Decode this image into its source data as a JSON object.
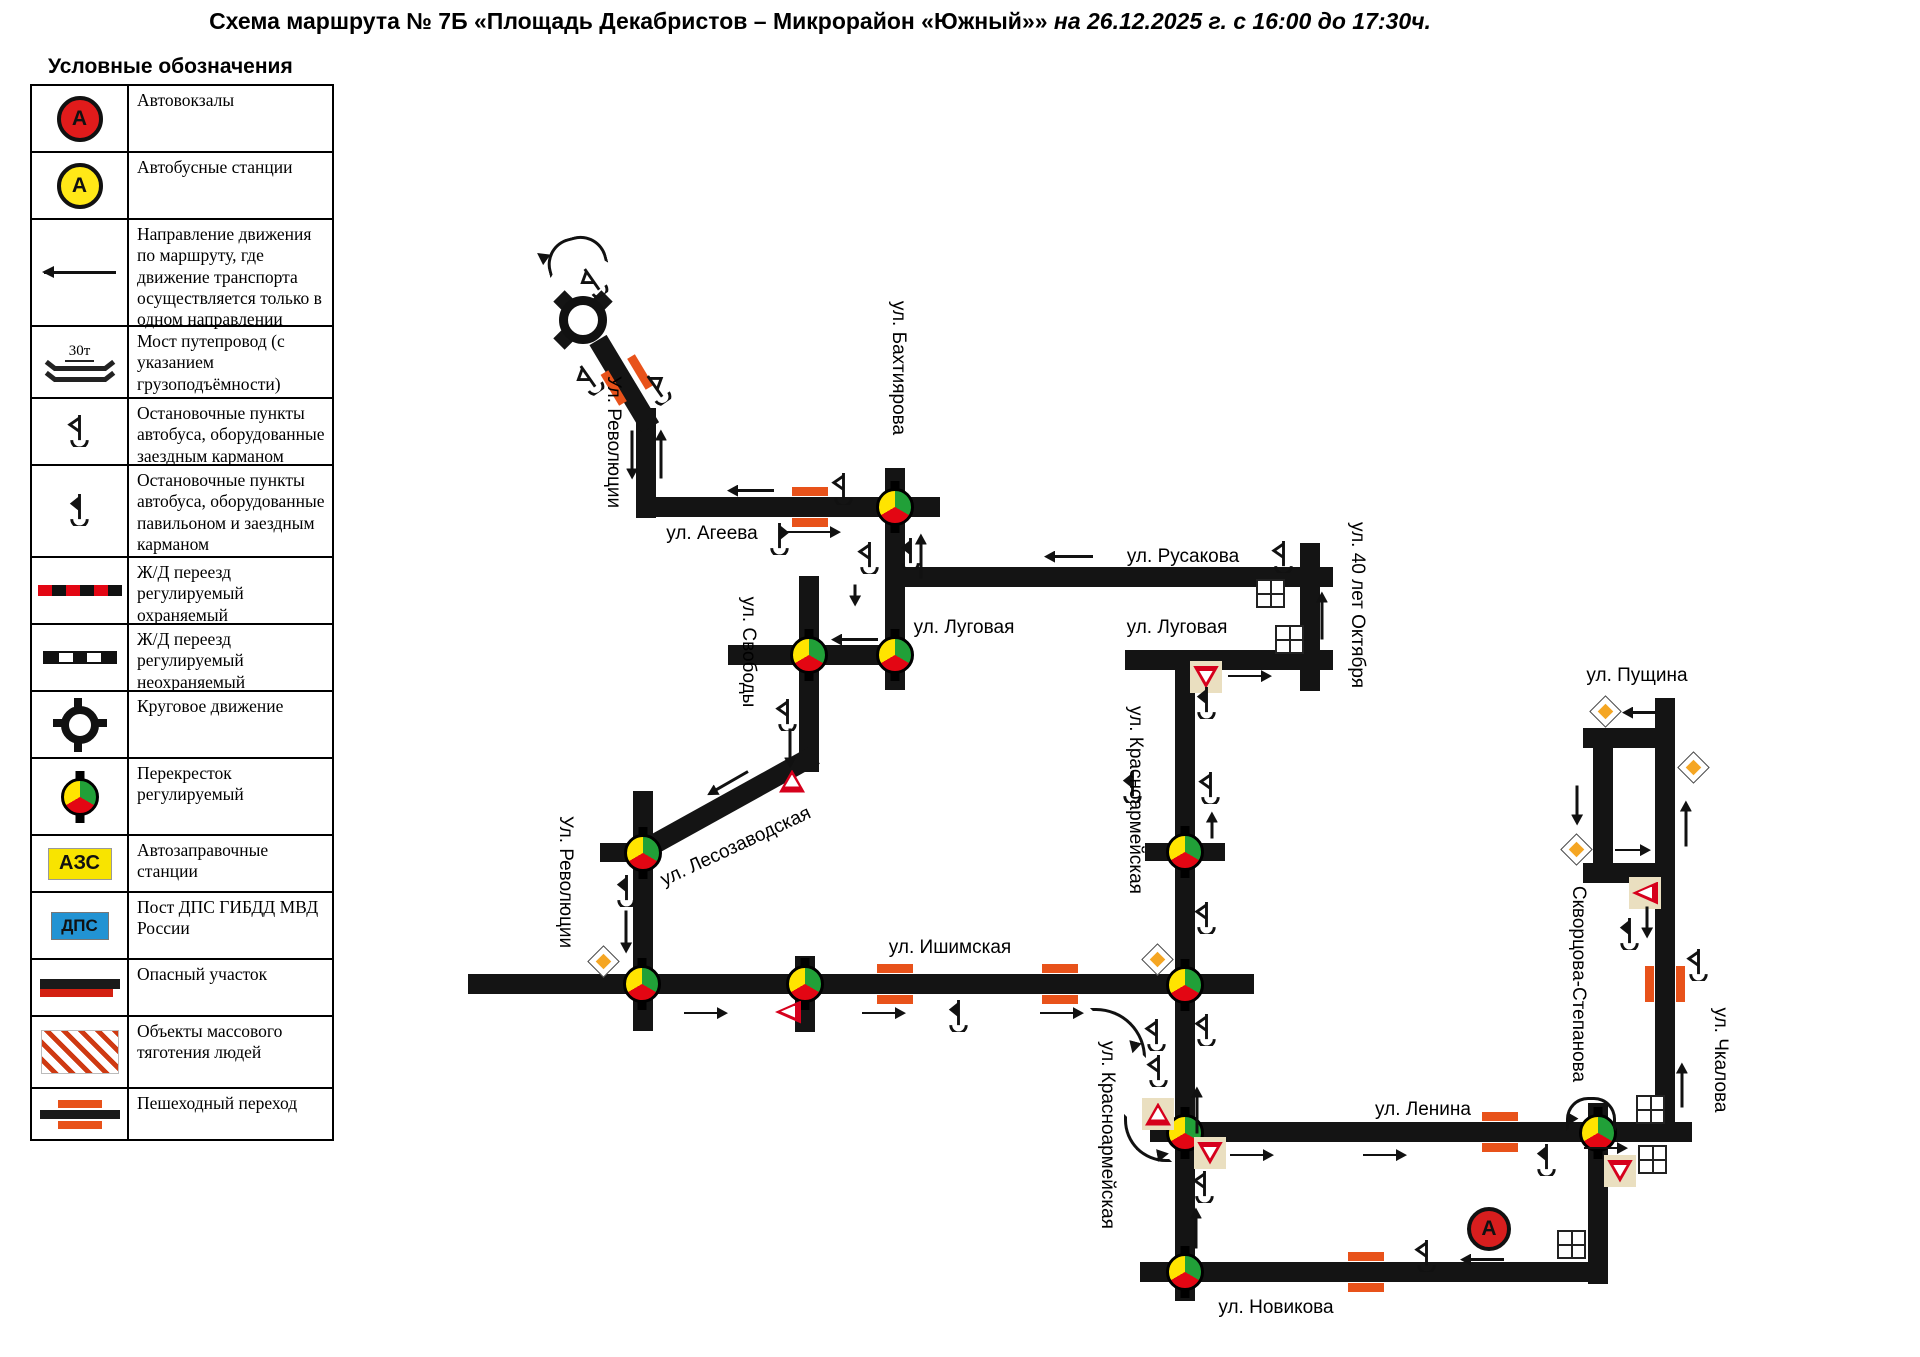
{
  "title": {
    "prefix": "Схема маршрута № 7Б «Площадь Декабристов – Микрорайон «Южный»»",
    "suffix": " на 26.12.2025 г. с 16:00 до 17:30ч."
  },
  "legend": {
    "heading": "Условные обозначения",
    "items": [
      {
        "icon": "bus-terminal-icon",
        "label": "Автовокзалы",
        "symbol": "А"
      },
      {
        "icon": "bus-station-icon",
        "label": "Автобусные станции",
        "symbol": "А"
      },
      {
        "icon": "one-way-arrow-icon",
        "label": "Направление движения по маршруту, где движение транспорта осуществляется  только в одном направлении"
      },
      {
        "icon": "bridge-icon",
        "label": "Мост путепровод (с указанием грузоподъёмности)",
        "bridge_text": "30т"
      },
      {
        "icon": "bus-stop-pocket-icon",
        "label": "Остановочные пункты автобуса, оборудованные заездным карманом"
      },
      {
        "icon": "bus-stop-pavilion-icon",
        "label": "Остановочные пункты автобуса, оборудованные павильоном и заездным карманом"
      },
      {
        "icon": "rail-crossing-guarded-icon",
        "label": "Ж/Д переезд регулируемый охраняемый"
      },
      {
        "icon": "rail-crossing-unguarded-icon",
        "label": "Ж/Д переезд регулируемый неохраняемый"
      },
      {
        "icon": "roundabout-icon",
        "label": "Круговое движение"
      },
      {
        "icon": "signal-intersection-icon",
        "label": "Перекресток регулируемый"
      },
      {
        "icon": "fuel-station-icon",
        "label": "Автозаправочные станции",
        "badge": "АЗС"
      },
      {
        "icon": "police-post-icon",
        "label": "Пост ДПС ГИБДД МВД России",
        "badge": "ДПС"
      },
      {
        "icon": "danger-section-icon",
        "label": "Опасный участок"
      },
      {
        "icon": "crowd-attraction-icon",
        "label": "Объекты массового тяготения людей"
      },
      {
        "icon": "pedestrian-crossing-icon",
        "label": "Пешеходный переход"
      }
    ],
    "row_heights": [
      65,
      65,
      105,
      70,
      65,
      90,
      65,
      65,
      65,
      75,
      55,
      65,
      55,
      70,
      50
    ]
  },
  "map": {
    "colors": {
      "road": "#141414",
      "crossing": "#e8521a",
      "light_yellow": "#ffe400",
      "light_green": "#21a038",
      "light_red": "#e30613",
      "sign_bg": "#eadfc0",
      "diamond_orange": "#f5a623",
      "yield_red": "#d6001c",
      "terminal_red": "#d81e1e",
      "station_yellow": "#ffe817"
    },
    "street_labels": [
      {
        "text": "Ул. Революции",
        "x": 613,
        "y": 442,
        "rot": 90
      },
      {
        "text": "ул. Агеева",
        "x": 712,
        "y": 534,
        "rot": 0
      },
      {
        "text": "ул. Бахтиярова",
        "x": 898,
        "y": 368,
        "rot": 90
      },
      {
        "text": "ул. Русакова",
        "x": 1183,
        "y": 557,
        "rot": 0
      },
      {
        "text": "ул. 40 лет Октября",
        "x": 1357,
        "y": 605,
        "rot": 90
      },
      {
        "text": "ул. Свободы",
        "x": 748,
        "y": 652,
        "rot": 90
      },
      {
        "text": "ул. Луговая",
        "x": 964,
        "y": 628,
        "rot": 0
      },
      {
        "text": "ул. Луговая",
        "x": 1177,
        "y": 628,
        "rot": 0
      },
      {
        "text": "ул. Красноармейская",
        "x": 1135,
        "y": 800,
        "rot": 90
      },
      {
        "text": "ул. Лесозаводская",
        "x": 736,
        "y": 847,
        "rot": -25
      },
      {
        "text": "Ул. Революции",
        "x": 565,
        "y": 882,
        "rot": 90
      },
      {
        "text": "ул. Ишимская",
        "x": 950,
        "y": 948,
        "rot": 0
      },
      {
        "text": "ул. Красноармейская",
        "x": 1107,
        "y": 1135,
        "rot": 90
      },
      {
        "text": "ул. Ленина",
        "x": 1423,
        "y": 1110,
        "rot": 0
      },
      {
        "text": "ул. Пущина",
        "x": 1637,
        "y": 676,
        "rot": 0
      },
      {
        "text": "Скворцова-Степанова",
        "x": 1578,
        "y": 984,
        "rot": 90
      },
      {
        "text": "ул. Чкалова",
        "x": 1720,
        "y": 1060,
        "rot": 90
      },
      {
        "text": "ул. Новикова",
        "x": 1276,
        "y": 1308,
        "rot": 0
      }
    ],
    "roads": [
      {
        "x": 636,
        "y": 408,
        "w": 20,
        "h": 110
      },
      {
        "x": 636,
        "y": 497,
        "w": 304,
        "h": 20
      },
      {
        "x": 885,
        "y": 468,
        "w": 20,
        "h": 222
      },
      {
        "x": 885,
        "y": 567,
        "w": 448,
        "h": 20
      },
      {
        "x": 728,
        "y": 645,
        "w": 177,
        "h": 20
      },
      {
        "x": 799,
        "y": 576,
        "w": 20,
        "h": 196
      },
      {
        "x": 640,
        "y": 842,
        "w": 200,
        "h": 20,
        "rot": -29
      },
      {
        "x": 598,
        "y": 330,
        "w": 102,
        "h": 20,
        "rot": 59
      },
      {
        "x": 633,
        "y": 791,
        "w": 20,
        "h": 240
      },
      {
        "x": 468,
        "y": 974,
        "w": 786,
        "h": 20
      },
      {
        "x": 795,
        "y": 956,
        "w": 20,
        "h": 76
      },
      {
        "x": 1175,
        "y": 653,
        "w": 20,
        "h": 648
      },
      {
        "x": 1125,
        "y": 650,
        "w": 208,
        "h": 20
      },
      {
        "x": 1300,
        "y": 543,
        "w": 20,
        "h": 148
      },
      {
        "x": 1145,
        "y": 843,
        "w": 80,
        "h": 18
      },
      {
        "x": 1150,
        "y": 1122,
        "w": 542,
        "h": 20
      },
      {
        "x": 1588,
        "y": 1103,
        "w": 20,
        "h": 181
      },
      {
        "x": 1655,
        "y": 698,
        "w": 20,
        "h": 436
      },
      {
        "x": 1583,
        "y": 728,
        "w": 92,
        "h": 20
      },
      {
        "x": 1583,
        "y": 863,
        "w": 92,
        "h": 20
      },
      {
        "x": 1593,
        "y": 728,
        "w": 20,
        "h": 155
      },
      {
        "x": 1140,
        "y": 1262,
        "w": 468,
        "h": 20
      },
      {
        "x": 600,
        "y": 843,
        "w": 33,
        "h": 19
      },
      {
        "x": 583,
        "y": 312,
        "w": 34,
        "h": 16,
        "rot": -45
      },
      {
        "x": 583,
        "y": 312,
        "w": 34,
        "h": 16,
        "rot": -135
      },
      {
        "x": 583,
        "y": 312,
        "w": 34,
        "h": 16,
        "rot": 135
      }
    ],
    "roundabout": {
      "x": 583,
      "y": 320
    },
    "terminal": {
      "x": 1489,
      "y": 1229,
      "symbol": "А"
    },
    "traffic_lights": [
      {
        "x": 895,
        "y": 507
      },
      {
        "x": 809,
        "y": 655
      },
      {
        "x": 895,
        "y": 655
      },
      {
        "x": 643,
        "y": 853
      },
      {
        "x": 642,
        "y": 984
      },
      {
        "x": 805,
        "y": 984
      },
      {
        "x": 1185,
        "y": 852
      },
      {
        "x": 1185,
        "y": 985
      },
      {
        "x": 1185,
        "y": 1133
      },
      {
        "x": 1185,
        "y": 1272
      },
      {
        "x": 1598,
        "y": 1133
      }
    ],
    "crossings": [
      {
        "x": 810,
        "y": 507,
        "rot": 0
      },
      {
        "x": 627,
        "y": 380,
        "rot": 59
      },
      {
        "x": 895,
        "y": 984,
        "rot": 0
      },
      {
        "x": 1060,
        "y": 984,
        "rot": 0
      },
      {
        "x": 1500,
        "y": 1132,
        "rot": 0
      },
      {
        "x": 1366,
        "y": 1272,
        "rot": 0
      },
      {
        "x": 1665,
        "y": 984,
        "rot": 90
      }
    ],
    "signs": [
      {
        "type": "diamond",
        "x": 603,
        "y": 961
      },
      {
        "type": "diamond",
        "x": 1157,
        "y": 959
      },
      {
        "type": "diamond",
        "x": 1605,
        "y": 711
      },
      {
        "type": "diamond",
        "x": 1693,
        "y": 767
      },
      {
        "type": "diamond",
        "x": 1576,
        "y": 849
      },
      {
        "type": "yield-down",
        "x": 1206,
        "y": 677,
        "boxed": true
      },
      {
        "type": "yield-up",
        "x": 792,
        "y": 781,
        "boxed": false
      },
      {
        "type": "yield-left",
        "x": 788,
        "y": 1012,
        "boxed": false
      },
      {
        "type": "yield-up",
        "x": 1158,
        "y": 1114,
        "boxed": true
      },
      {
        "type": "yield-left",
        "x": 1645,
        "y": 893,
        "boxed": true
      },
      {
        "type": "yield-down",
        "x": 1210,
        "y": 1153,
        "boxed": true
      },
      {
        "type": "yield-down",
        "x": 1620,
        "y": 1171,
        "boxed": true
      }
    ],
    "landmarks": [
      {
        "x": 1270,
        "y": 593
      },
      {
        "x": 1289,
        "y": 639
      },
      {
        "x": 1650,
        "y": 1109
      },
      {
        "x": 1652,
        "y": 1159
      },
      {
        "x": 1571,
        "y": 1244
      }
    ],
    "bus_stops": [
      {
        "x": 594,
        "y": 280,
        "rot": -35,
        "dir": "left",
        "type": "k"
      },
      {
        "x": 590,
        "y": 377,
        "rot": -35,
        "dir": "left",
        "type": "k"
      },
      {
        "x": 657,
        "y": 387,
        "rot": -35,
        "dir": "right",
        "type": "k"
      },
      {
        "x": 843,
        "y": 487,
        "rot": 0,
        "dir": "left",
        "type": "k"
      },
      {
        "x": 779,
        "y": 537,
        "rot": 0,
        "dir": "right",
        "type": "p"
      },
      {
        "x": 869,
        "y": 556,
        "rot": 0,
        "dir": "left",
        "type": "k"
      },
      {
        "x": 910,
        "y": 552,
        "rot": 0,
        "dir": "left",
        "type": "p"
      },
      {
        "x": 1283,
        "y": 555,
        "rot": 0,
        "dir": "left",
        "type": "k"
      },
      {
        "x": 1206,
        "y": 701,
        "rot": 0,
        "dir": "left",
        "type": "p"
      },
      {
        "x": 787,
        "y": 713,
        "rot": 0,
        "dir": "left",
        "type": "k"
      },
      {
        "x": 1132,
        "y": 785,
        "rot": 0,
        "dir": "left",
        "type": "p"
      },
      {
        "x": 1210,
        "y": 786,
        "rot": 0,
        "dir": "left",
        "type": "k"
      },
      {
        "x": 1206,
        "y": 916,
        "rot": 0,
        "dir": "left",
        "type": "k"
      },
      {
        "x": 626,
        "y": 889,
        "rot": 0,
        "dir": "left",
        "type": "p"
      },
      {
        "x": 958,
        "y": 1014,
        "rot": 0,
        "dir": "left",
        "type": "p"
      },
      {
        "x": 1156,
        "y": 1033,
        "rot": 0,
        "dir": "left",
        "type": "k"
      },
      {
        "x": 1206,
        "y": 1028,
        "rot": 0,
        "dir": "left",
        "type": "k"
      },
      {
        "x": 1158,
        "y": 1069,
        "rot": 0,
        "dir": "left",
        "type": "k"
      },
      {
        "x": 1204,
        "y": 1185,
        "rot": 0,
        "dir": "left",
        "type": "k"
      },
      {
        "x": 1546,
        "y": 1158,
        "rot": 0,
        "dir": "left",
        "type": "p"
      },
      {
        "x": 1426,
        "y": 1254,
        "rot": 0,
        "dir": "left",
        "type": "k"
      },
      {
        "x": 1629,
        "y": 932,
        "rot": 0,
        "dir": "left",
        "type": "p"
      },
      {
        "x": 1698,
        "y": 963,
        "rot": 0,
        "dir": "left",
        "type": "k"
      }
    ],
    "arrows": [
      {
        "x1": 632,
        "y1": 430,
        "x2": 632,
        "y2": 478
      },
      {
        "x1": 661,
        "y1": 478,
        "x2": 661,
        "y2": 430
      },
      {
        "x1": 774,
        "y1": 490,
        "x2": 728,
        "y2": 490
      },
      {
        "x1": 780,
        "y1": 532,
        "x2": 840,
        "y2": 532
      },
      {
        "x1": 921,
        "y1": 578,
        "x2": 921,
        "y2": 534
      },
      {
        "x1": 1093,
        "y1": 556,
        "x2": 1045,
        "y2": 556
      },
      {
        "x1": 855,
        "y1": 584,
        "x2": 855,
        "y2": 605
      },
      {
        "x1": 878,
        "y1": 639,
        "x2": 832,
        "y2": 639
      },
      {
        "x1": 1322,
        "y1": 639,
        "x2": 1322,
        "y2": 592
      },
      {
        "x1": 1228,
        "y1": 676,
        "x2": 1271,
        "y2": 676
      },
      {
        "x1": 790,
        "y1": 728,
        "x2": 790,
        "y2": 767
      },
      {
        "x1": 748,
        "y1": 771,
        "x2": 708,
        "y2": 794
      },
      {
        "x1": 626,
        "y1": 910,
        "x2": 626,
        "y2": 952
      },
      {
        "x1": 684,
        "y1": 1013,
        "x2": 727,
        "y2": 1013
      },
      {
        "x1": 862,
        "y1": 1013,
        "x2": 905,
        "y2": 1013
      },
      {
        "x1": 1040,
        "y1": 1013,
        "x2": 1083,
        "y2": 1013
      },
      {
        "x1": 1212,
        "y1": 838,
        "x2": 1212,
        "y2": 812
      },
      {
        "x1": 1197,
        "y1": 1133,
        "x2": 1197,
        "y2": 1087
      },
      {
        "x1": 1230,
        "y1": 1155,
        "x2": 1273,
        "y2": 1155
      },
      {
        "x1": 1363,
        "y1": 1155,
        "x2": 1406,
        "y2": 1155
      },
      {
        "x1": 1196,
        "y1": 1248,
        "x2": 1196,
        "y2": 1208
      },
      {
        "x1": 1504,
        "y1": 1259,
        "x2": 1461,
        "y2": 1259
      },
      {
        "x1": 1656,
        "y1": 712,
        "x2": 1623,
        "y2": 712
      },
      {
        "x1": 1577,
        "y1": 785,
        "x2": 1577,
        "y2": 824
      },
      {
        "x1": 1686,
        "y1": 846,
        "x2": 1686,
        "y2": 801
      },
      {
        "x1": 1615,
        "y1": 850,
        "x2": 1650,
        "y2": 850
      },
      {
        "x1": 1647,
        "y1": 906,
        "x2": 1647,
        "y2": 937
      },
      {
        "x1": 1682,
        "y1": 1107,
        "x2": 1682,
        "y2": 1063
      },
      {
        "x1": 1584,
        "y1": 1148,
        "x2": 1627,
        "y2": 1148
      }
    ],
    "turn_arrows": [
      {
        "x": 545,
        "y": 237,
        "w": 54,
        "h": 28,
        "kind": "top",
        "rot": -15,
        "hx": 542,
        "hy": 256,
        "hrot": 215
      },
      {
        "x": 1090,
        "y": 1008,
        "w": 50,
        "h": 44,
        "kind": "tr",
        "rot": 0,
        "hx": 1134,
        "hy": 1047,
        "hrot": 105
      },
      {
        "x": 1124,
        "y": 1114,
        "w": 42,
        "h": 42,
        "kind": "bl",
        "rot": 0,
        "hx": 1163,
        "hy": 1154,
        "hrot": -10
      },
      {
        "x": 1566,
        "y": 1097,
        "w": 44,
        "h": 28,
        "kind": "top",
        "rot": 0,
        "hx": 1570,
        "hy": 1120,
        "hrot": 120
      }
    ]
  }
}
